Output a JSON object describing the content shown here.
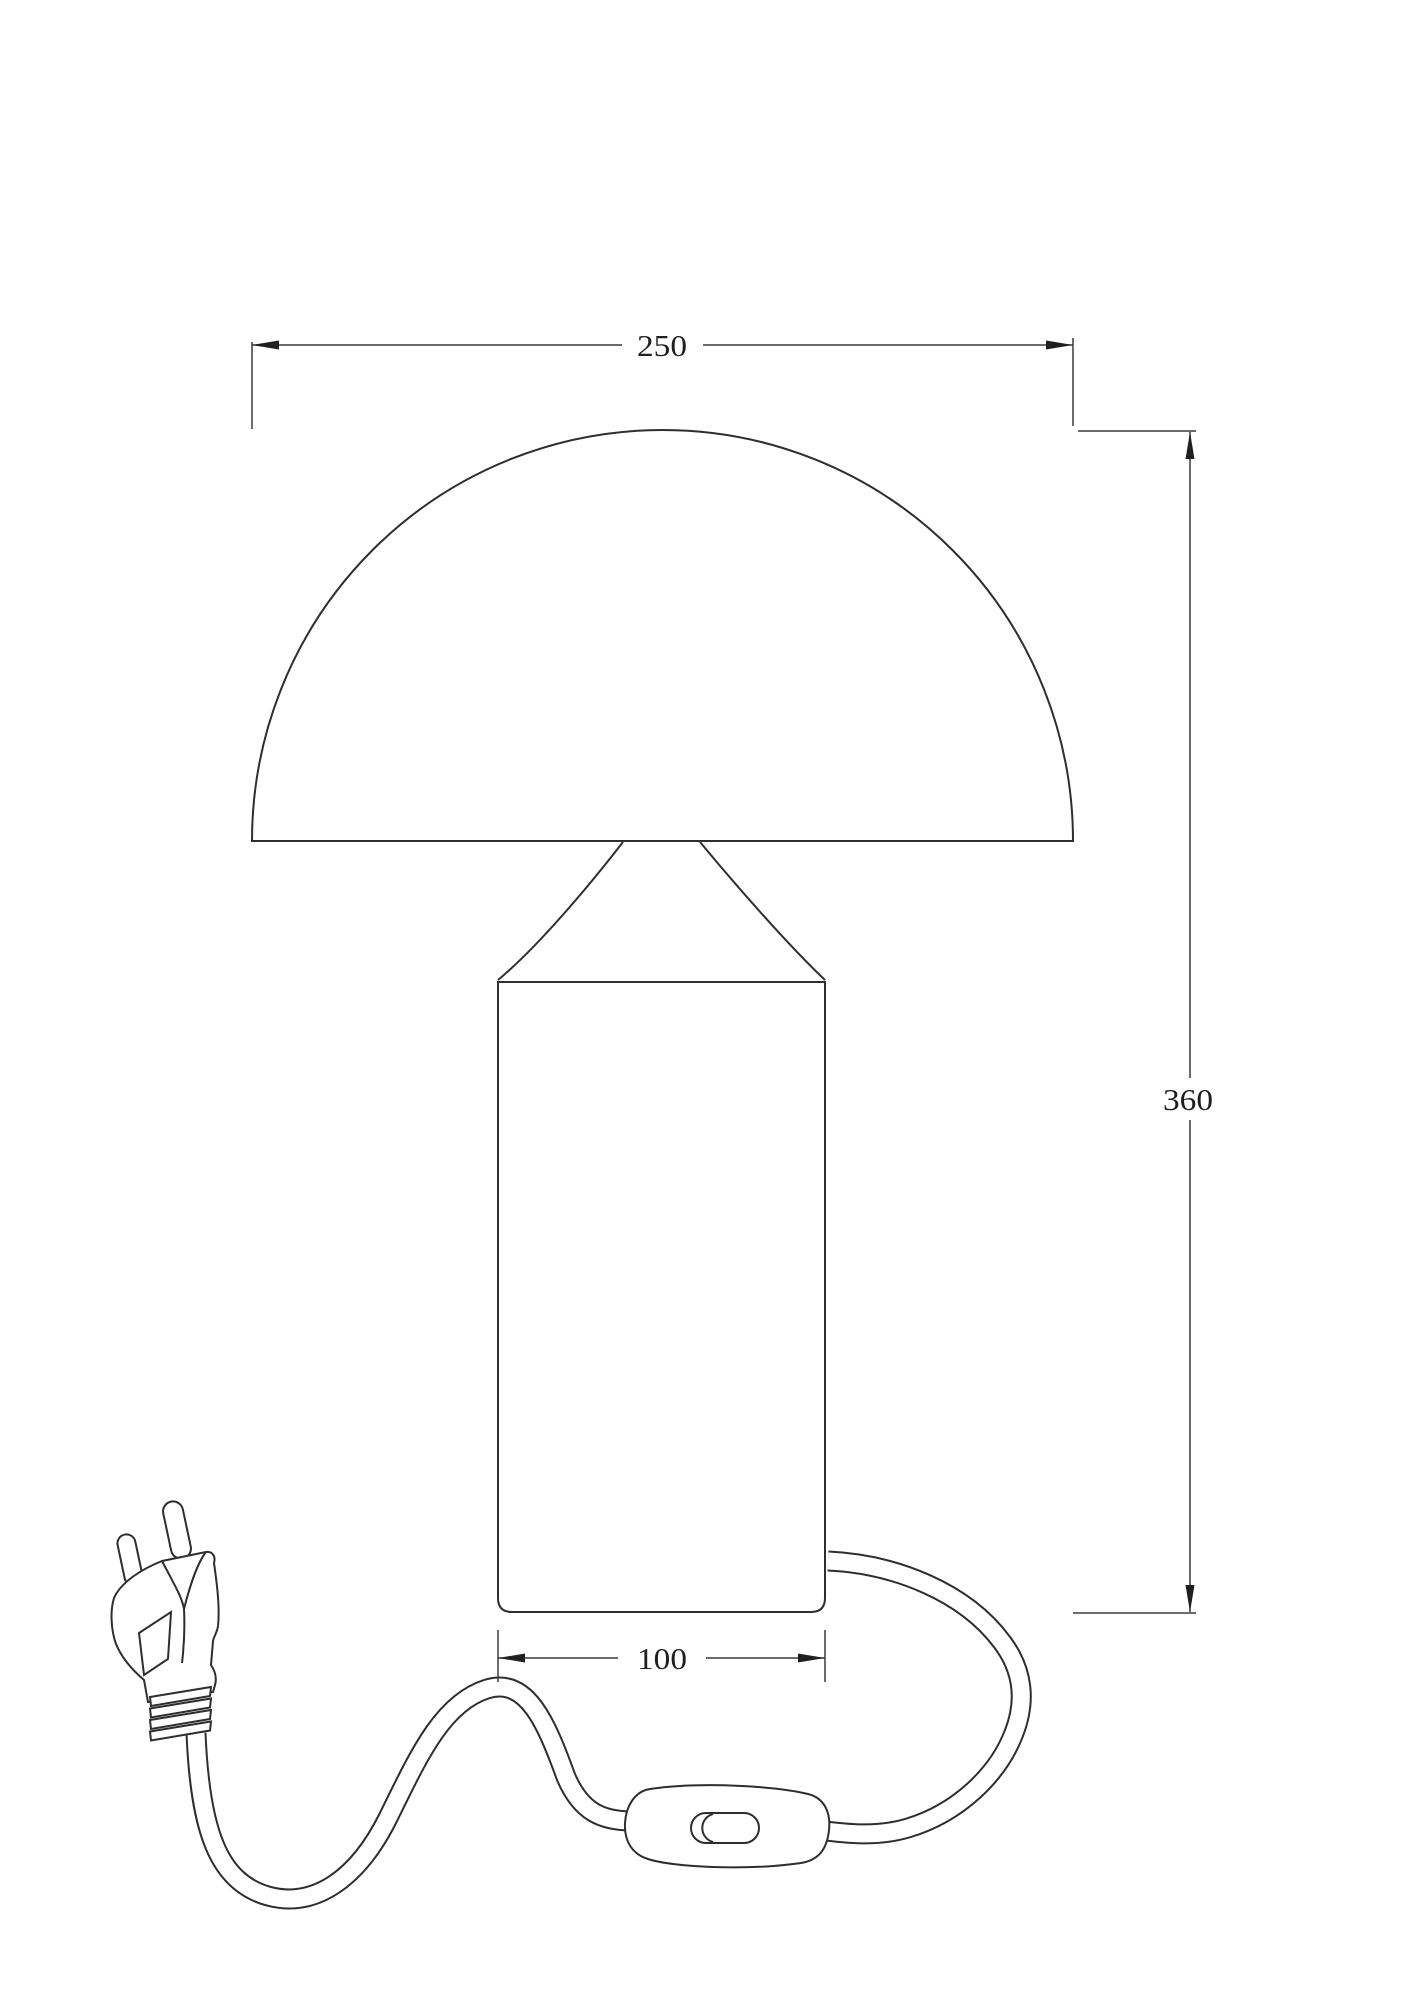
{
  "drawing": {
    "type": "technical-dimension-drawing",
    "subject": "mushroom table lamp with power cord, inline switch and euro plug",
    "background_color": "#ffffff",
    "line_color": "#2e2e2e",
    "dimensions": {
      "shade_diameter": "250",
      "total_height": "360",
      "base_width": "100"
    }
  }
}
